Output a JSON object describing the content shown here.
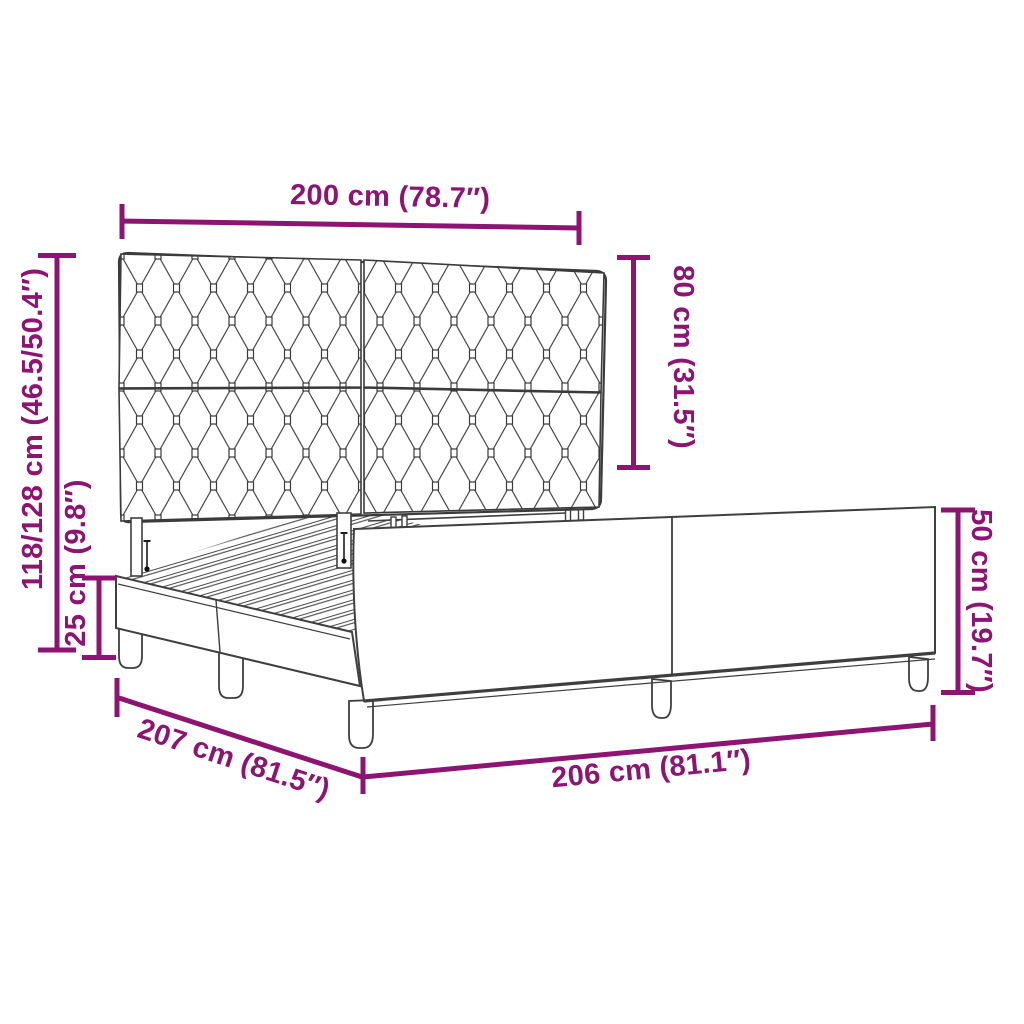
{
  "page": {
    "background": "#ffffff"
  },
  "diagram": {
    "title": "Bed frame with tufted headboard — dimension diagram",
    "accent_color": "#8d1472",
    "line_color": "#3f3f3f",
    "dimensions": {
      "headboard_width": "200 cm (78.7″)",
      "headboard_panel_height": "80 cm (31.5″)",
      "total_height": "118/128 cm (46.5/50.4″)",
      "base_height": "25 cm (9.8″)",
      "frame_depth": "207 cm (81.5″)",
      "frame_length": "206 cm (81.1″)",
      "side_rail_height": "50 cm (19.7″)"
    }
  }
}
